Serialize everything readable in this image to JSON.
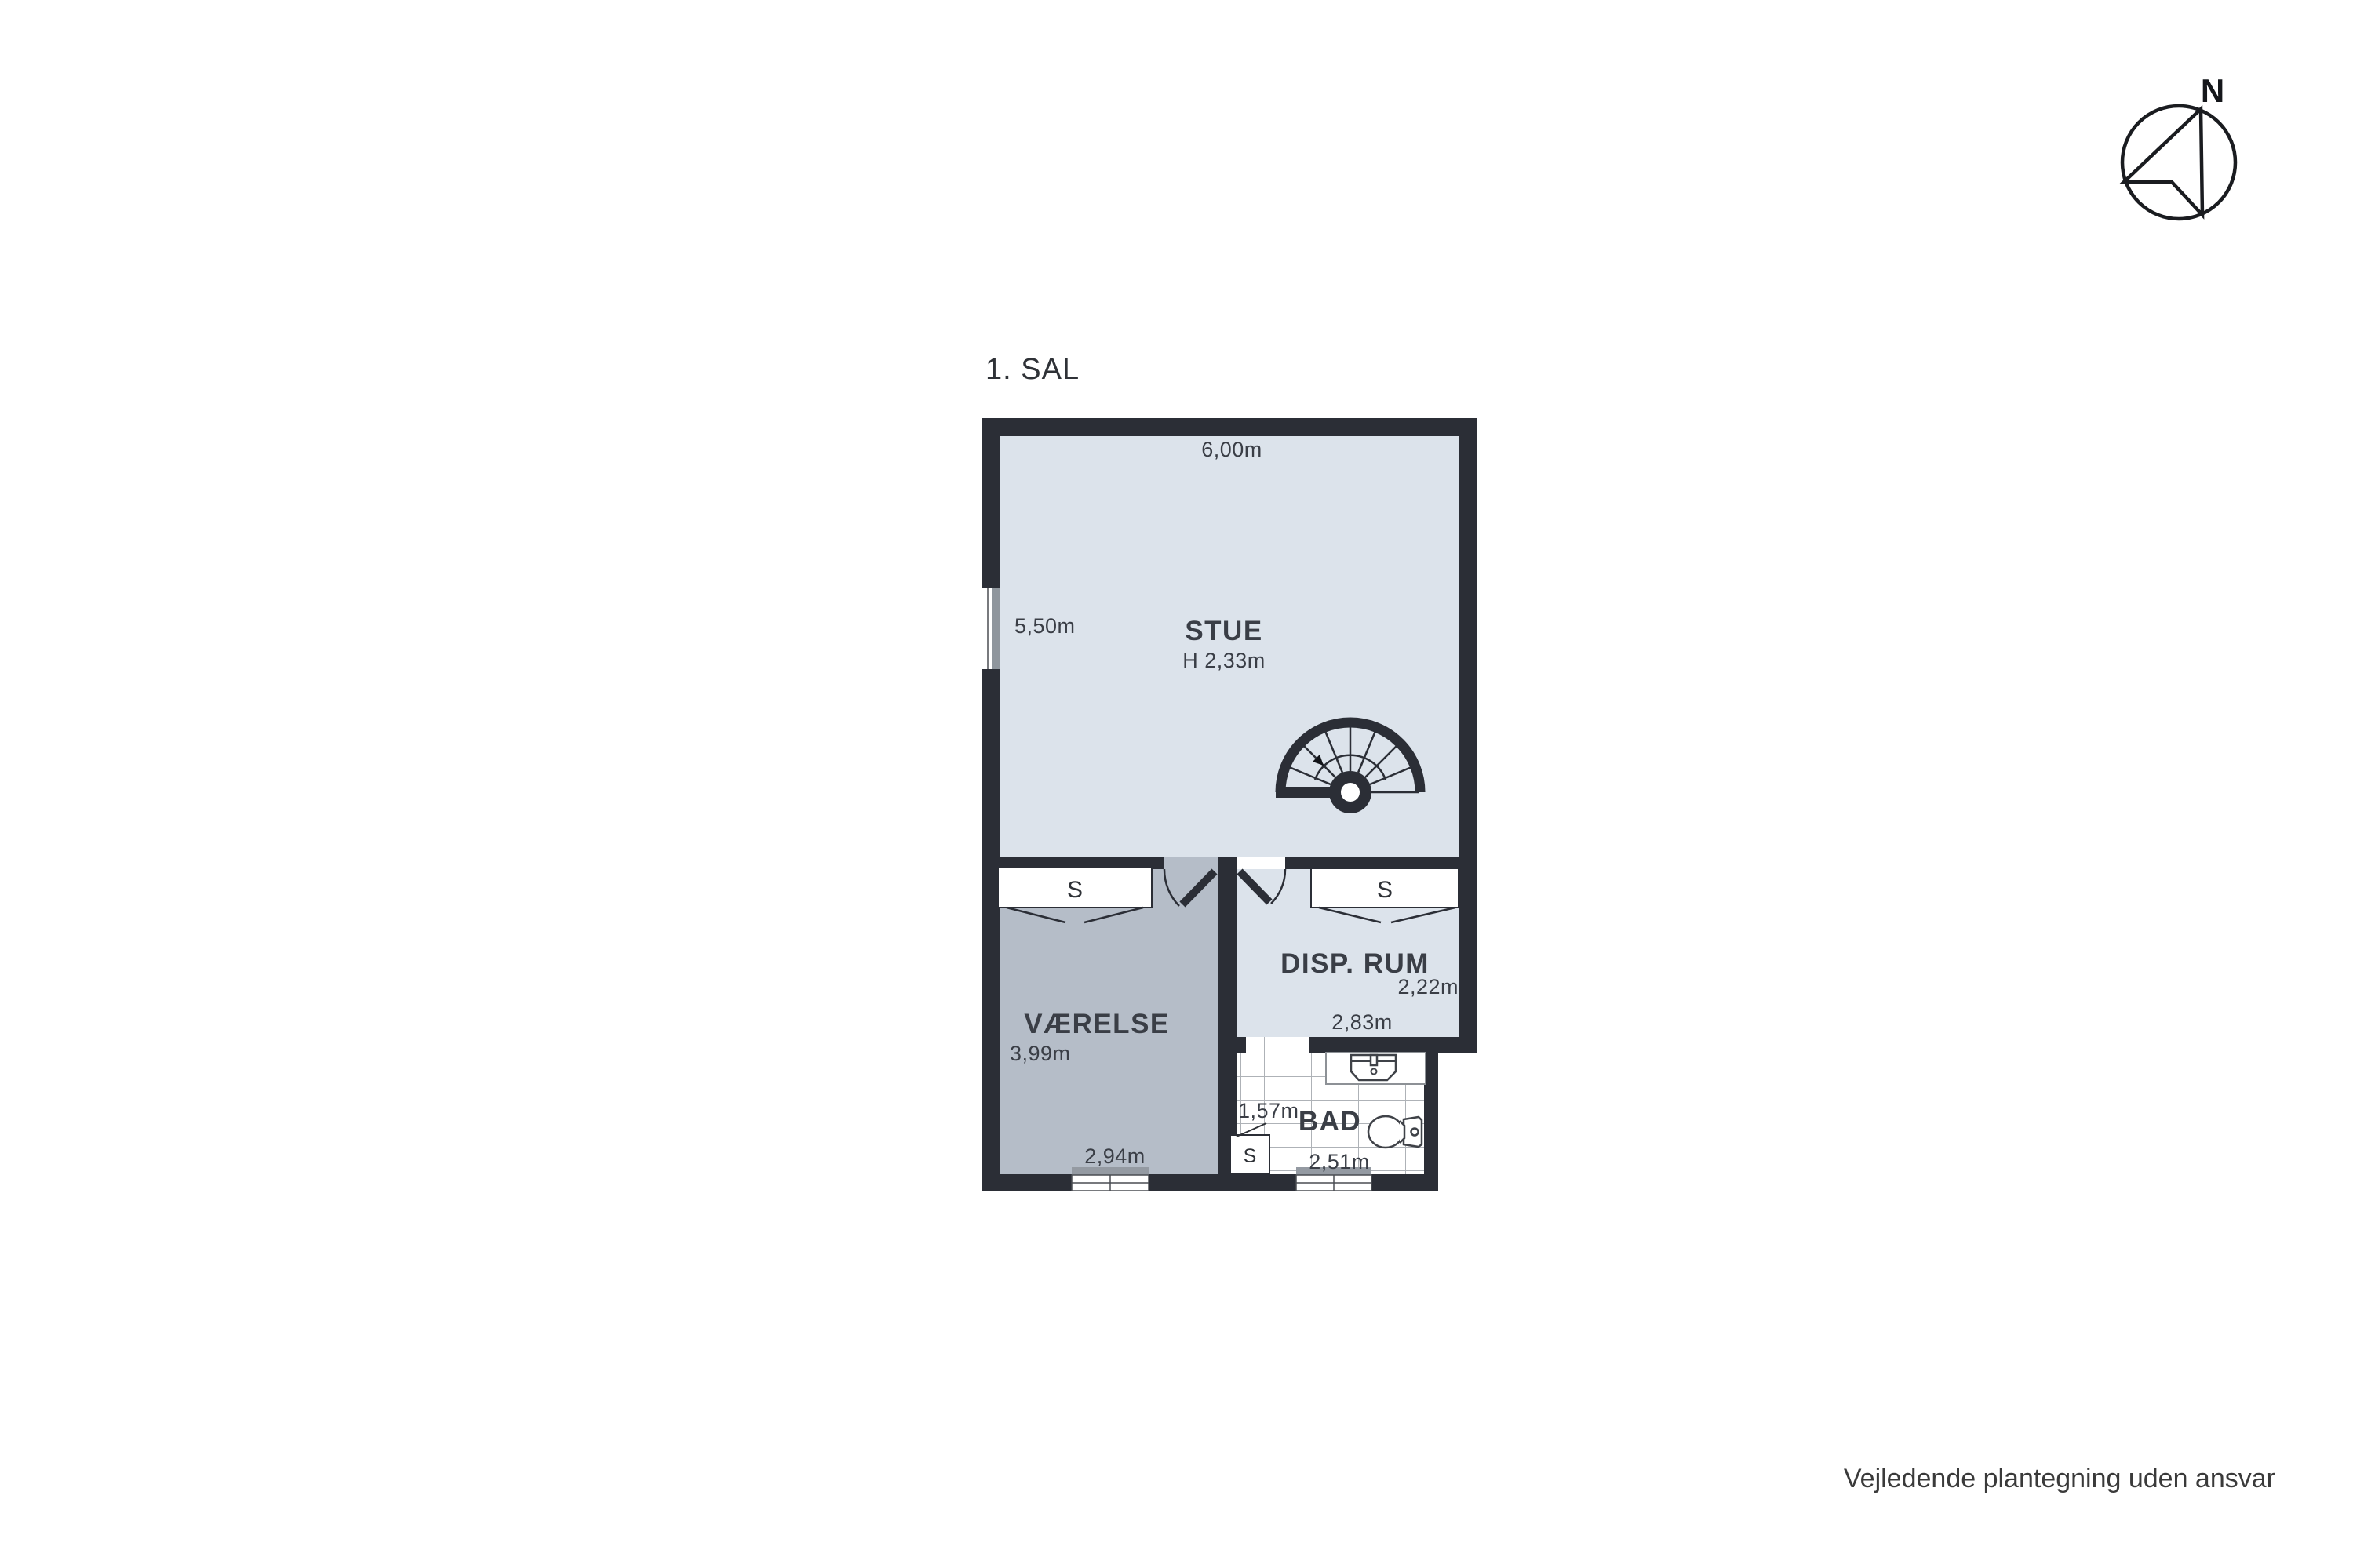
{
  "title": "1. SAL",
  "disclaimer": "Vejledende plantegning uden ansvar",
  "compass": {
    "north_label": "N"
  },
  "rooms": {
    "stue": {
      "name": "STUE",
      "ceiling_height": "H 2,33m",
      "top_dim": "6,00m",
      "side_dim": "5,50m"
    },
    "vaerelse": {
      "name": "VÆRELSE",
      "side_dim": "3,99m",
      "bottom_dim": "2,94m",
      "closet_label": "S"
    },
    "disp_rum": {
      "name": "DISP. RUM",
      "side_dim": "2,22m",
      "bottom_dim": "2,83m",
      "closet_label": "S"
    },
    "bad": {
      "name": "BAD",
      "side_dim": "1,57m",
      "bottom_dim": "2,51m",
      "closet_label": "S"
    }
  },
  "colors": {
    "wall": "#2b2e36",
    "floor_light": "#dce3eb",
    "floor_gray": "#b5bdc8",
    "window_sill": "#949aa2",
    "label_text": "#3a3e46",
    "background": "#ffffff"
  }
}
